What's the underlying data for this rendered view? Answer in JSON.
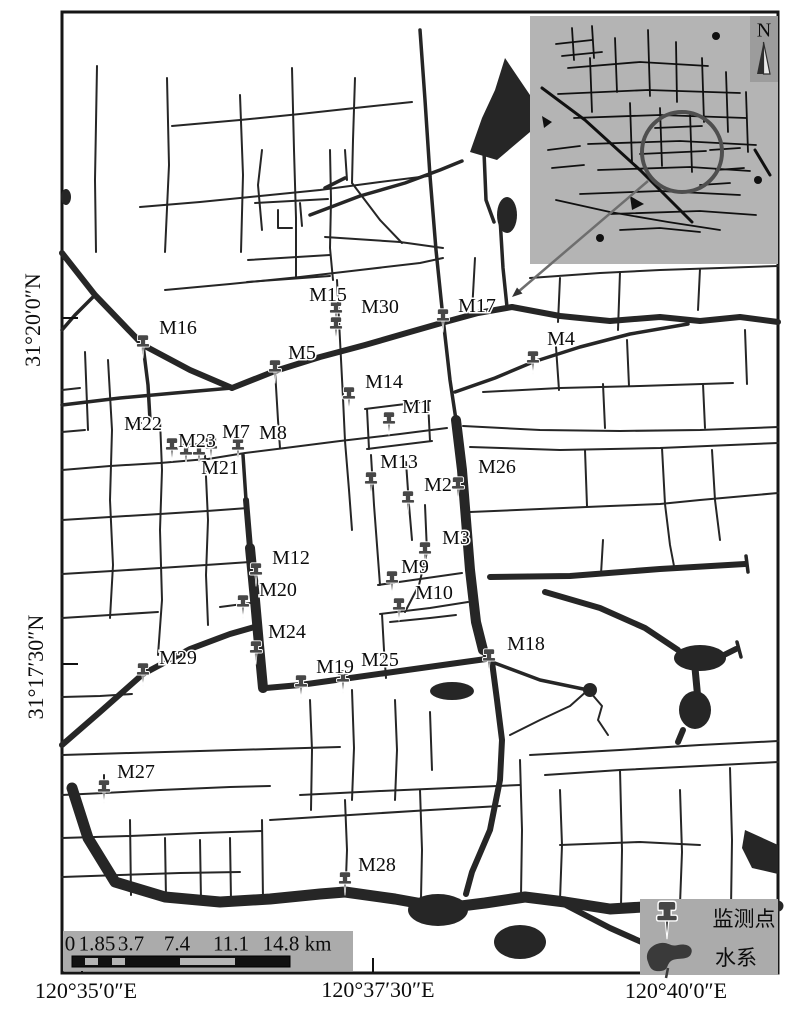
{
  "axes": {
    "lat": [
      {
        "text": "31°20′0″N"
      },
      {
        "text": "31°17′30″N"
      }
    ],
    "lon": [
      {
        "text": "120°35′0″E"
      },
      {
        "text": "120°37′30″E"
      },
      {
        "text": "120°40′0″E"
      }
    ]
  },
  "scalebar": {
    "ticks": [
      "0",
      "1.85",
      "3.7",
      "7.4",
      "11.1",
      "14.8"
    ],
    "unit": "km"
  },
  "legend": {
    "items": [
      {
        "icon": "pushpin-icon",
        "label": "监测点"
      },
      {
        "icon": "water-body-icon",
        "label": "水系"
      }
    ]
  },
  "inset": {
    "north_label": "N"
  },
  "map": {
    "points": [
      {
        "id": "M1",
        "label_x": 416,
        "label_y": 406,
        "pin_x": 389,
        "pin_y": 421
      },
      {
        "id": "M2",
        "label_x": 438,
        "label_y": 484,
        "pin_x": 408,
        "pin_y": 500
      },
      {
        "id": "M3",
        "label_x": 456,
        "label_y": 537,
        "pin_x": 425,
        "pin_y": 551
      },
      {
        "id": "M4",
        "label_x": 561,
        "label_y": 338,
        "pin_x": 533,
        "pin_y": 360
      },
      {
        "id": "M5",
        "label_x": 302,
        "label_y": 352,
        "pin_x": 275,
        "pin_y": 369
      },
      {
        "id": "M7",
        "label_x": 236,
        "label_y": 431,
        "pin_x": 211,
        "pin_y": 446
      },
      {
        "id": "M8",
        "label_x": 273,
        "label_y": 432,
        "pin_x": 238,
        "pin_y": 447
      },
      {
        "id": "M9",
        "label_x": 415,
        "label_y": 566,
        "pin_x": 392,
        "pin_y": 580
      },
      {
        "id": "M10",
        "label_x": 434,
        "label_y": 592,
        "pin_x": 399,
        "pin_y": 607
      },
      {
        "id": "M12",
        "label_x": 291,
        "label_y": 557,
        "pin_x": 256,
        "pin_y": 572
      },
      {
        "id": "M13",
        "label_x": 399,
        "label_y": 461,
        "pin_x": 371,
        "pin_y": 481
      },
      {
        "id": "M14",
        "label_x": 384,
        "label_y": 381,
        "pin_x": 349,
        "pin_y": 396
      },
      {
        "id": "M15",
        "label_x": 328,
        "label_y": 294,
        "pin_x": 336,
        "pin_y": 310
      },
      {
        "id": "M16",
        "label_x": 178,
        "label_y": 327,
        "pin_x": 143,
        "pin_y": 344
      },
      {
        "id": "M17",
        "label_x": 477,
        "label_y": 305,
        "pin_x": 443,
        "pin_y": 318
      },
      {
        "id": "M18",
        "label_x": 526,
        "label_y": 643,
        "pin_x": 489,
        "pin_y": 658
      },
      {
        "id": "M19",
        "label_x": 335,
        "label_y": 666,
        "pin_x": 301,
        "pin_y": 684
      },
      {
        "id": "M20",
        "label_x": 278,
        "label_y": 589,
        "pin_x": 243,
        "pin_y": 604
      },
      {
        "id": "M21",
        "label_x": 220,
        "label_y": 467,
        "pin_x": 199,
        "pin_y": 452
      },
      {
        "id": "M22",
        "label_x": 143,
        "label_y": 423,
        "pin_x": 172,
        "pin_y": 447
      },
      {
        "id": "M23",
        "label_x": 197,
        "label_y": 440,
        "pin_x": 186,
        "pin_y": 452
      },
      {
        "id": "M24",
        "label_x": 287,
        "label_y": 631,
        "pin_x": 256,
        "pin_y": 650
      },
      {
        "id": "M25",
        "label_x": 380,
        "label_y": 659,
        "pin_x": 343,
        "pin_y": 679
      },
      {
        "id": "M26",
        "label_x": 497,
        "label_y": 466,
        "pin_x": 458,
        "pin_y": 486
      },
      {
        "id": "M27",
        "label_x": 136,
        "label_y": 771,
        "pin_x": 104,
        "pin_y": 789
      },
      {
        "id": "M28",
        "label_x": 377,
        "label_y": 864,
        "pin_x": 345,
        "pin_y": 881
      },
      {
        "id": "M29",
        "label_x": 178,
        "label_y": 657,
        "pin_x": 143,
        "pin_y": 672
      },
      {
        "id": "M30",
        "label_x": 380,
        "label_y": 306,
        "pin_x": 336,
        "pin_y": 326
      }
    ]
  },
  "colors": {
    "map_line": "#262626",
    "panel_gray": "#ababab",
    "inset_gray": "#b4b4b4",
    "north_box_gray": "#9c9c9c",
    "pin_gray": "#474747"
  }
}
